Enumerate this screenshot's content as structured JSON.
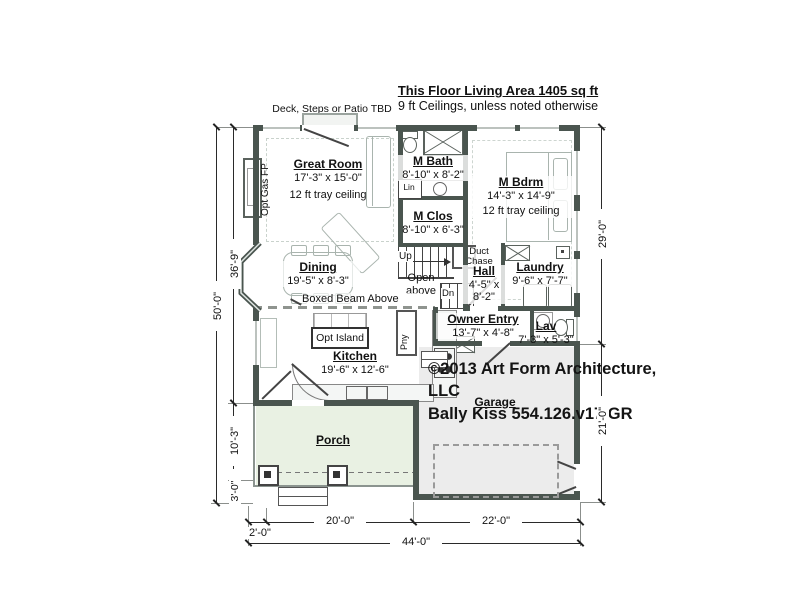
{
  "title": {
    "living_area": "This Floor Living Area 1405 sq ft",
    "ceilings": "9 ft Ceilings, unless noted otherwise"
  },
  "deck_note": "Deck, Steps or Patio TBD",
  "rooms": {
    "great_room": {
      "name": "Great Room",
      "dims": "17'-3\" x 15'-0\"",
      "note": "12 ft tray ceiling"
    },
    "m_bath": {
      "name": "M Bath",
      "dims": "8'-10\" x 8'-2\""
    },
    "m_bdrm": {
      "name": "M Bdrm",
      "dims": "14'-3\" x 14'-9\"",
      "note": "12 ft tray ceiling"
    },
    "m_clos": {
      "name": "M Clos",
      "dims": "8'-10\" x 6'-3\""
    },
    "dining": {
      "name": "Dining",
      "dims": "19'-5\" x 8'-3\""
    },
    "hall": {
      "name": "Hall",
      "dims": "4'-5\" x 8'-2\""
    },
    "laundry": {
      "name": "Laundry",
      "dims": "9'-6\" x 7'-7\""
    },
    "owner_entry": {
      "name": "Owner Entry",
      "dims": "13'-7\" x 4'-8\""
    },
    "lav": {
      "name": "Lav",
      "dims": "7'-3\" x 5'-3\""
    },
    "kitchen": {
      "name": "Kitchen",
      "dims": "19'-6\" x 12'-6\""
    },
    "porch": {
      "name": "Porch"
    },
    "garage": {
      "name": "Garage"
    }
  },
  "labels": {
    "up": "Up",
    "dn": "Dn",
    "open_above": "Open above",
    "duct_chase": "Duct Chase",
    "lin": "Lin",
    "pantry": "Pny",
    "opt_island": "Opt Island",
    "opt_gas_fp": "Opt Gas FP",
    "boxed_beam": "Boxed Beam Above"
  },
  "copyright": {
    "line1": "©2013 Art Form Architecture, LLC",
    "line2": "Bally Kiss 554.126.v17 GR"
  },
  "dimensions": {
    "left_total": "50'-0\"",
    "left_upper": "36'-9\"",
    "left_mid": "10'-3\"",
    "left_lower": "3'-0\"",
    "right_upper": "29'-0\"",
    "right_lower": "21'-0\"",
    "bottom_offset": "2'-0\"",
    "bottom_left": "20'-0\"",
    "bottom_right": "22'-0\"",
    "bottom_total": "44'-0\""
  },
  "colors": {
    "wall": "#4a554f",
    "porch_fill": "#e9f1e3",
    "garage_fill": "#ececec",
    "furniture": "#a9b4ae"
  }
}
